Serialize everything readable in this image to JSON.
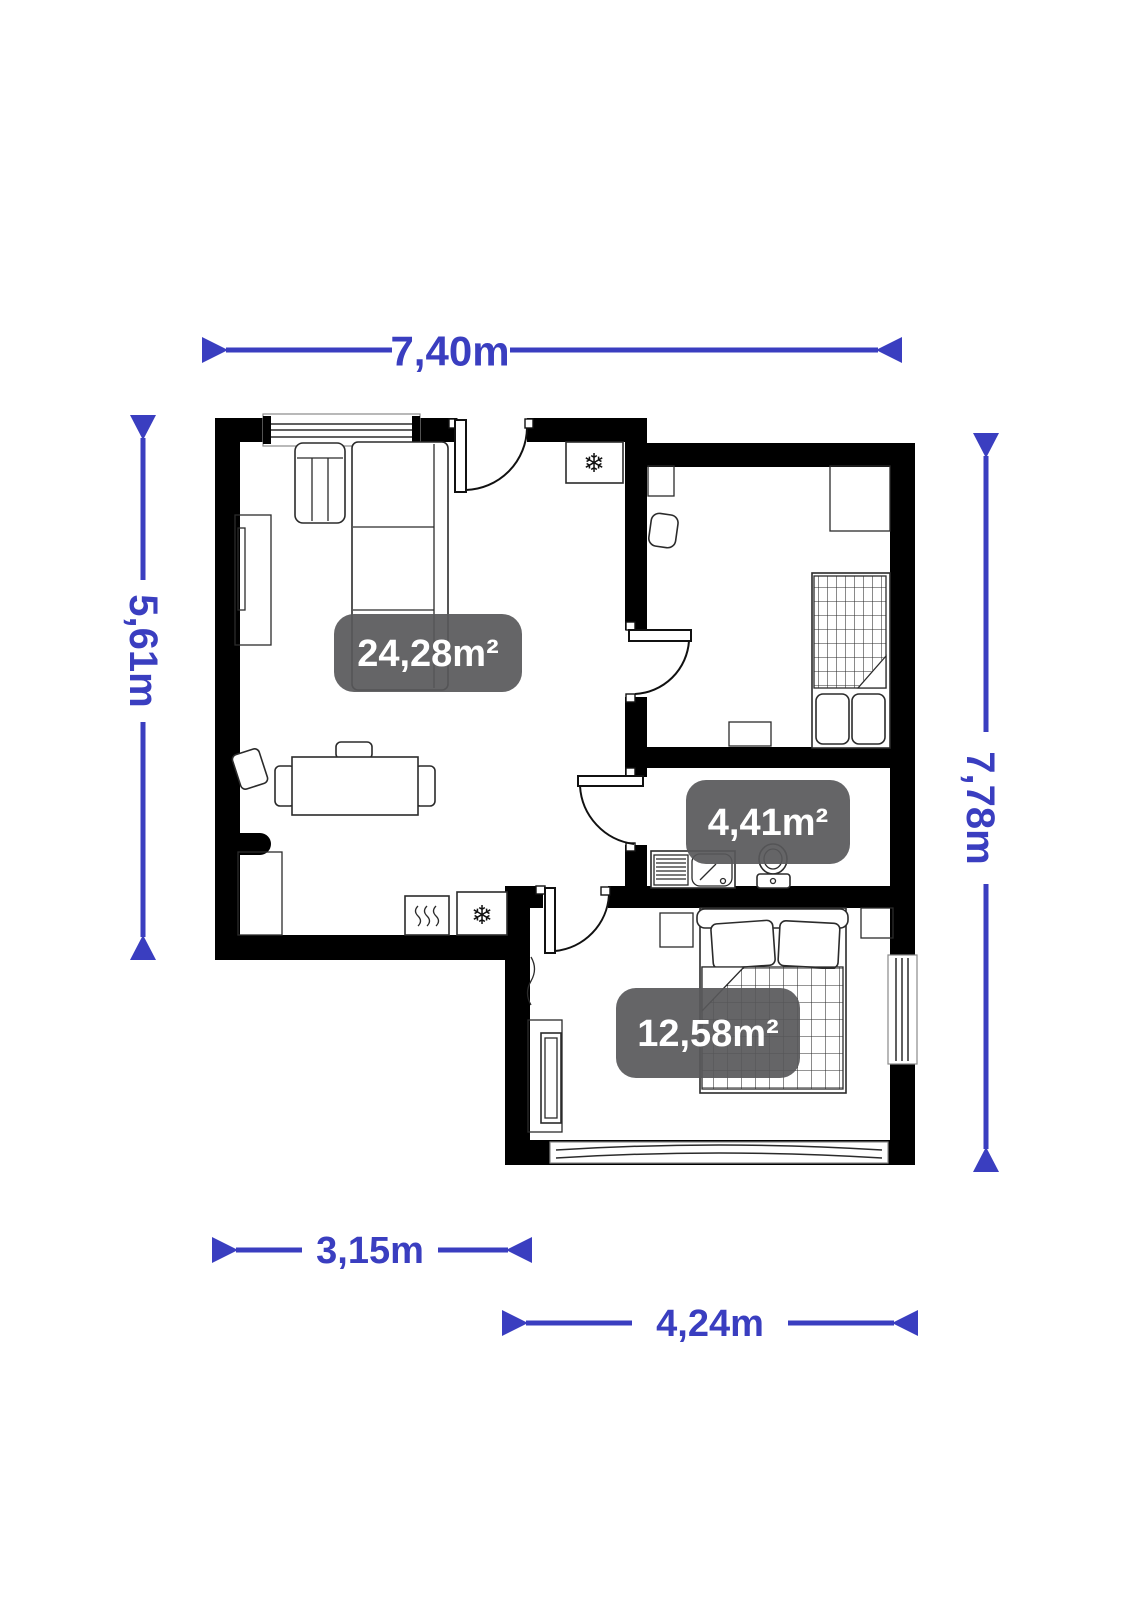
{
  "floor_plan": {
    "dimensions": {
      "top": "7,40m",
      "left": "5,61m",
      "right": "7,78m",
      "bottom_inner": "3,15m",
      "bottom_outer": "4,24m"
    },
    "rooms": [
      {
        "name": "living-room-kitchen",
        "area": "24,28m²"
      },
      {
        "name": "bathroom",
        "area": "4,41m²"
      },
      {
        "name": "bedroom",
        "area": "12,58m²"
      }
    ],
    "icons": {
      "freezer_hall": "❄",
      "freezer_kitchen": "❄",
      "stove_steam": "≋"
    },
    "colors": {
      "dimension_blue": "#3a3ec0",
      "wall_black": "#000000",
      "badge_background": "rgba(88,88,90,0.92)",
      "badge_text": "#ffffff"
    }
  }
}
